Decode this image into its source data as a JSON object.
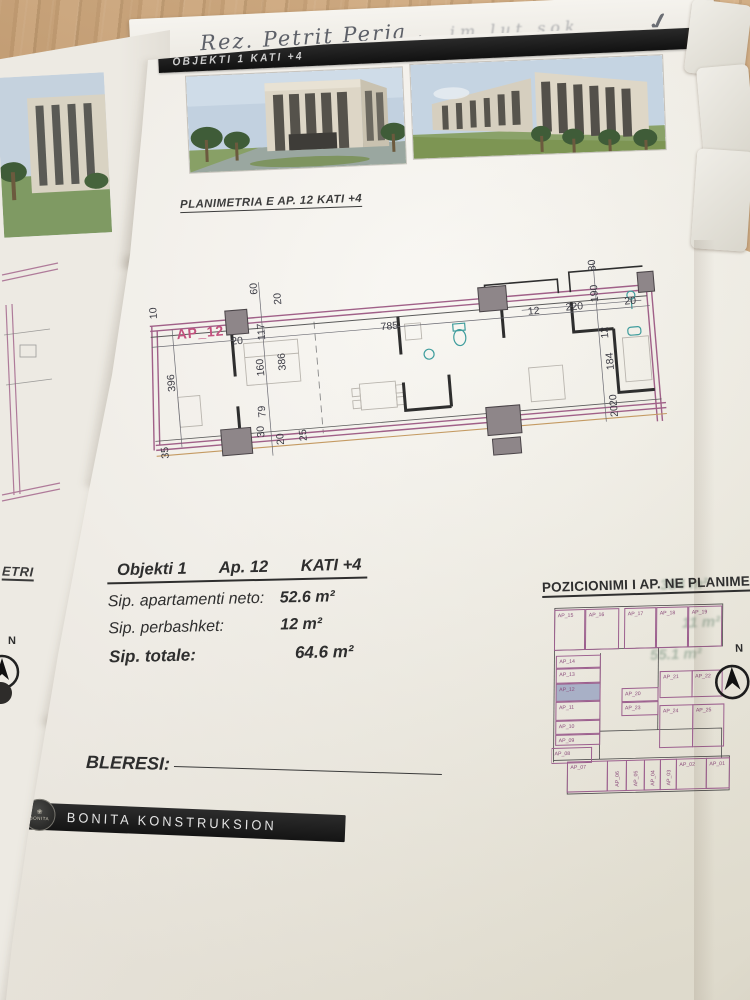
{
  "photo": {
    "handwriting": "Rez. Petrit Perja ,",
    "handwriting_faint": "im lut  sok",
    "checkmark": "✓"
  },
  "left_page": {
    "heading_fragment": "ETRI",
    "compass_label": "N"
  },
  "page": {
    "header_bar_title": "OBJEKTI 1   KATI +4",
    "plan_heading": "PLANIMETRIA E AP. 12   KATI +4",
    "summary": {
      "objekti": "Objekti 1",
      "ap": "Ap. 12",
      "kati": "KATI +4",
      "rows": [
        {
          "label": "Sip. apartamenti neto:",
          "value": "52.6 m²"
        },
        {
          "label": "Sip. perbashket:",
          "value": "12 m²"
        },
        {
          "label": "Sip. totale:",
          "value": "64.6 m²"
        }
      ]
    },
    "position_heading": "POZICIONIMI I AP. NE PLANIMETRI",
    "buyer_label": "BLERESI:",
    "footer_company": "BONITA KONSTRUKSION",
    "footer_logo_text": "BONITA",
    "compass_label": "N"
  },
  "floor_plan": {
    "apartment_id": "AP_12",
    "dimensions": [
      {
        "t": "10",
        "x": 16,
        "y": 40,
        "r": -90
      },
      {
        "t": "396",
        "x": 28,
        "y": 114,
        "r": -90
      },
      {
        "t": "35",
        "x": 16,
        "y": 180,
        "r": -90
      },
      {
        "t": "60",
        "x": 118,
        "y": 24,
        "r": -90
      },
      {
        "t": "20",
        "x": 141,
        "y": 36,
        "r": -90
      },
      {
        "t": "20",
        "x": 88,
        "y": 72,
        "r": 0
      },
      {
        "t": "117",
        "x": 122,
        "y": 70,
        "r": -90
      },
      {
        "t": "160",
        "x": 118,
        "y": 106,
        "r": -90
      },
      {
        "t": "386",
        "x": 140,
        "y": 102,
        "r": -90
      },
      {
        "t": "785",
        "x": 238,
        "y": 70,
        "r": 0
      },
      {
        "t": "79",
        "x": 116,
        "y": 147,
        "r": -90
      },
      {
        "t": "30",
        "x": 113,
        "y": 167,
        "r": -90
      },
      {
        "t": "20",
        "x": 132,
        "y": 176,
        "r": -90
      },
      {
        "t": "25",
        "x": 155,
        "y": 174,
        "r": -90
      },
      {
        "t": "12",
        "x": 386,
        "y": 67,
        "r": 0
      },
      {
        "t": "220",
        "x": 424,
        "y": 66,
        "r": 0
      },
      {
        "t": "190",
        "x": 457,
        "y": 60,
        "r": -90
      },
      {
        "t": "20",
        "x": 483,
        "y": 65,
        "r": 0
      },
      {
        "t": "80",
        "x": 457,
        "y": 29,
        "r": -90
      },
      {
        "t": "12",
        "x": 464,
        "y": 97,
        "r": -90
      },
      {
        "t": "184",
        "x": 467,
        "y": 129,
        "r": -90
      },
      {
        "t": "20",
        "x": 467,
        "y": 165,
        "r": -90
      },
      {
        "t": "20",
        "x": 467,
        "y": 176,
        "r": -90
      }
    ]
  },
  "key_plan": {
    "highlighted_unit": "AP_12",
    "units": [
      {
        "id": "AP_15",
        "x": 2,
        "y": 8,
        "w": 30,
        "h": 40
      },
      {
        "id": "AP_16",
        "x": 33,
        "y": 8,
        "w": 33,
        "h": 40
      },
      {
        "id": "AP_17",
        "x": 72,
        "y": 8,
        "w": 31,
        "h": 40
      },
      {
        "id": "AP_18",
        "x": 104,
        "y": 8,
        "w": 31,
        "h": 40
      },
      {
        "id": "AP_19",
        "x": 136,
        "y": 8,
        "w": 33,
        "h": 40
      },
      {
        "id": "AP_14",
        "x": 4,
        "y": 54,
        "w": 44,
        "h": 12
      },
      {
        "id": "AP_13",
        "x": 4,
        "y": 67,
        "w": 44,
        "h": 14
      },
      {
        "id": "AP_12",
        "x": 4,
        "y": 82,
        "w": 44,
        "h": 17,
        "filled": true
      },
      {
        "id": "AP_11",
        "x": 4,
        "y": 100,
        "w": 44,
        "h": 18
      },
      {
        "id": "AP_10",
        "x": 4,
        "y": 119,
        "w": 44,
        "h": 13
      },
      {
        "id": "AP_09",
        "x": 4,
        "y": 133,
        "w": 44,
        "h": 10
      },
      {
        "id": "AP_08",
        "x": 0,
        "y": 146,
        "w": 40,
        "h": 15
      },
      {
        "id": "AP_21",
        "x": 108,
        "y": 72,
        "w": 32,
        "h": 26
      },
      {
        "id": "AP_22",
        "x": 140,
        "y": 72,
        "w": 30,
        "h": 26
      },
      {
        "id": "AP_20",
        "x": 70,
        "y": 88,
        "w": 36,
        "h": 13
      },
      {
        "id": "AP_23",
        "x": 70,
        "y": 102,
        "w": 36,
        "h": 13
      },
      {
        "id": "AP_24",
        "x": 108,
        "y": 106,
        "w": 33,
        "h": 42
      },
      {
        "id": "AP_25",
        "x": 141,
        "y": 106,
        "w": 31,
        "h": 42
      },
      {
        "id": "AP_07",
        "x": 16,
        "y": 160,
        "w": 40,
        "h": 30
      },
      {
        "id": "AP_06",
        "x": 56,
        "y": 160,
        "w": 19,
        "h": 30,
        "vertical": true
      },
      {
        "id": "AP_05",
        "x": 75,
        "y": 160,
        "w": 18,
        "h": 30,
        "vertical": true
      },
      {
        "id": "AP_04",
        "x": 93,
        "y": 160,
        "w": 16,
        "h": 30,
        "vertical": true
      },
      {
        "id": "AP_03",
        "x": 109,
        "y": 160,
        "w": 16,
        "h": 30,
        "vertical": true
      },
      {
        "id": "AP_02",
        "x": 125,
        "y": 160,
        "w": 30,
        "h": 30
      },
      {
        "id": "AP_01",
        "x": 155,
        "y": 160,
        "w": 23,
        "h": 30
      }
    ]
  },
  "ghost_bleedthrough": [
    {
      "text": "384 m²",
      "x": 660,
      "y": 576
    },
    {
      "text": "11 m²",
      "x": 682,
      "y": 614
    },
    {
      "text": "55.1 m²",
      "x": 650,
      "y": 646
    }
  ],
  "colors": {
    "plan_line_purple": "#a06088",
    "unit_outline_purple": "#9c5f8e",
    "apartment_label_magenta": "#c2527e",
    "fixture_teal": "#3f9d9d",
    "bar_black": "#1a1a1a"
  }
}
